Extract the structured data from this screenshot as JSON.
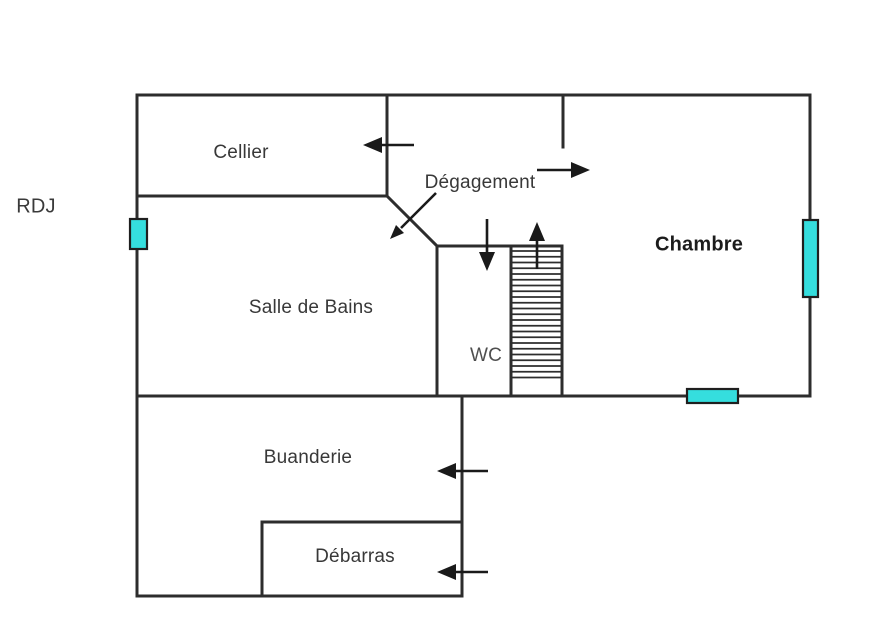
{
  "floor": {
    "label": "RDJ"
  },
  "rooms": {
    "cellier": {
      "label": "Cellier"
    },
    "degagement": {
      "label": "Dégagement"
    },
    "chambre": {
      "label": "Chambre"
    },
    "salle_de_bains": {
      "label": "Salle de Bains"
    },
    "wc": {
      "label": "WC"
    },
    "buanderie": {
      "label": "Buanderie"
    },
    "debarras": {
      "label": "Débarras"
    }
  },
  "colors": {
    "wall": "#2d2d2d",
    "window": "#35dede",
    "window_border": "#1f1f1f",
    "arrow": "#1a1a1a",
    "stair_tread": "#2d2d2d"
  },
  "symbols": {
    "windows": [
      {
        "name": "left-wall-window",
        "orientation": "vertical"
      },
      {
        "name": "right-wall-window",
        "orientation": "vertical"
      },
      {
        "name": "bottom-wall-window",
        "orientation": "horizontal"
      }
    ],
    "stairs": {
      "name": "staircase",
      "direction": "up"
    },
    "door_arrows": [
      {
        "name": "cellier-door-arrow",
        "direction": "left"
      },
      {
        "name": "chambre-door-arrow",
        "direction": "right"
      },
      {
        "name": "salle-de-bains-door-arrow",
        "direction": "down-left"
      },
      {
        "name": "wc-door-arrow",
        "direction": "down"
      },
      {
        "name": "stairs-up-arrow",
        "direction": "up"
      },
      {
        "name": "buanderie-door-arrow",
        "direction": "left"
      },
      {
        "name": "debarras-door-arrow",
        "direction": "left"
      }
    ]
  }
}
